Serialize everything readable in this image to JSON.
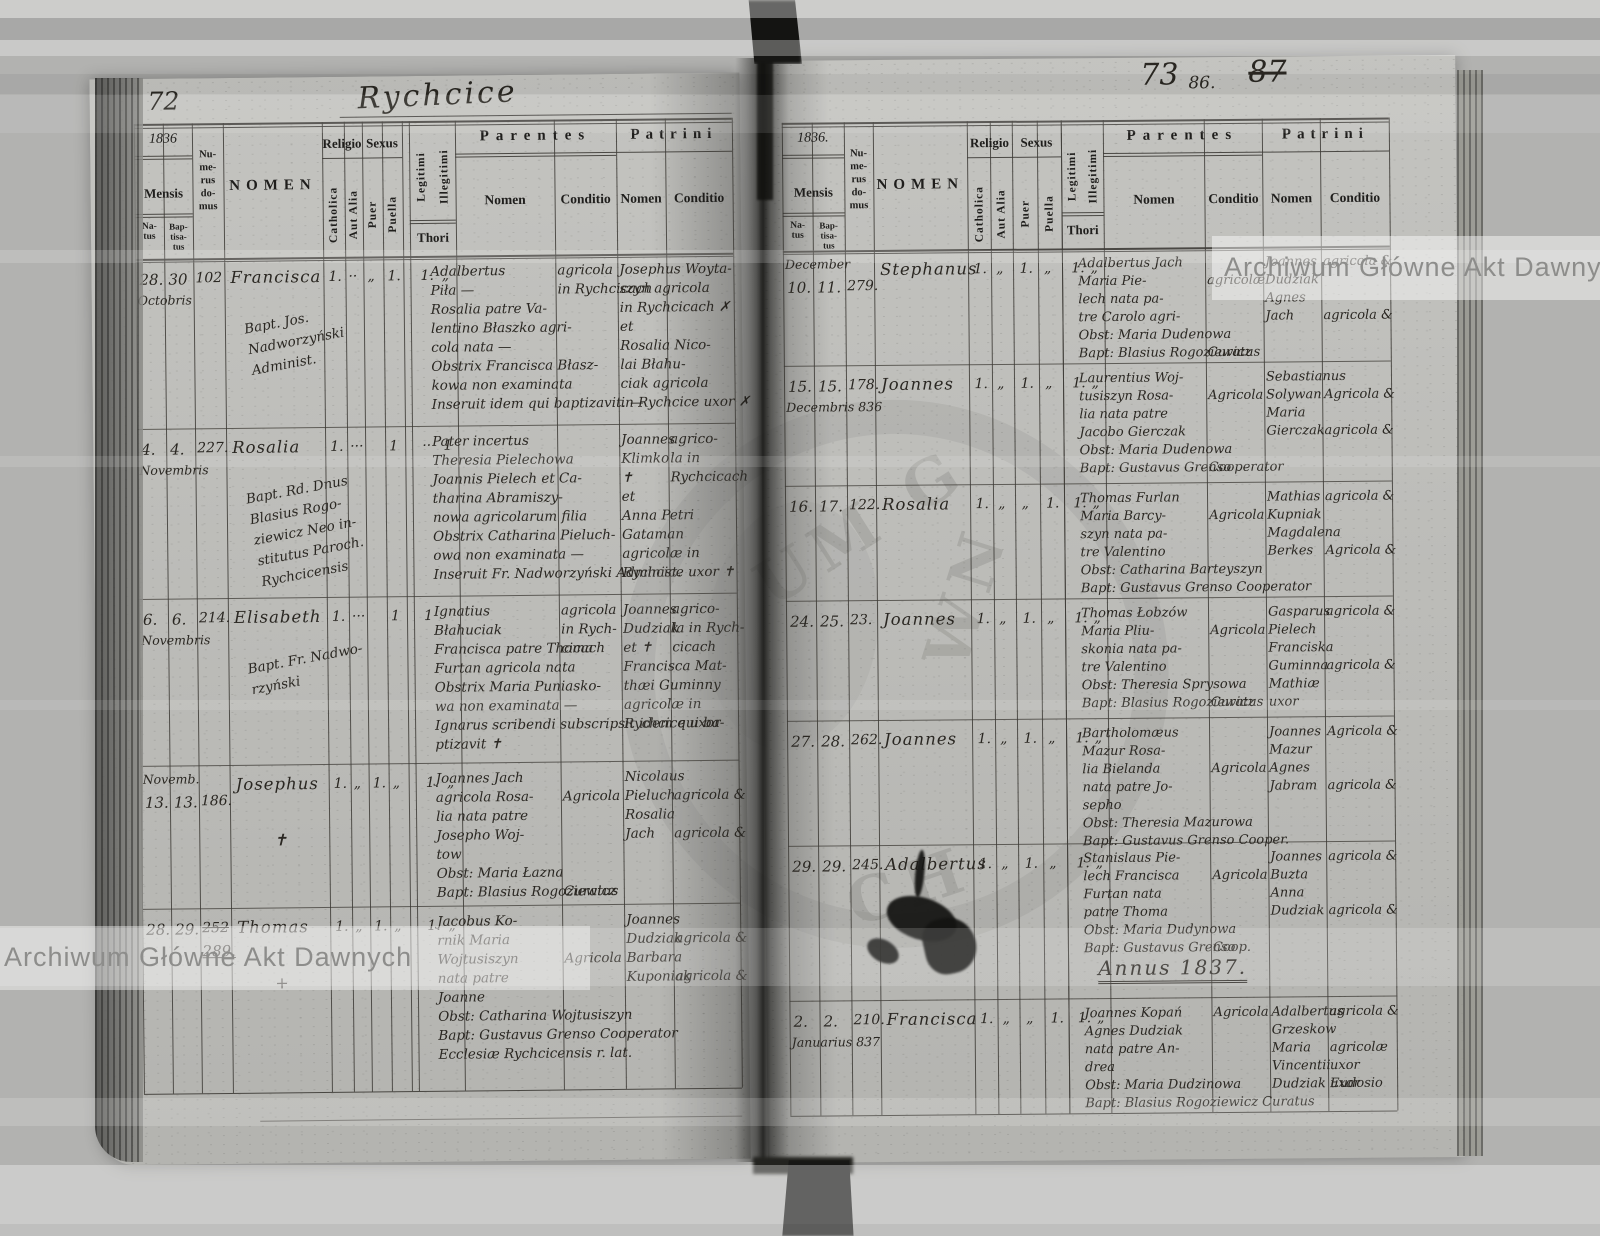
{
  "scan": {
    "watermark_text": "Archiwum Główne Akt Dawnych",
    "stamp_fragments": [
      "UM G",
      "WN",
      "CH"
    ]
  },
  "header_labels": {
    "mensis": "Mensis",
    "natus": "Na-\ntus",
    "baptisatus": "Bap-\ntisa-\ntus",
    "numerus_domus": "Nu-\nme-\nrus\ndo-\nmus",
    "nomen": "NOMEN",
    "religio": "Religio",
    "catholica": "Catholica",
    "aut_alia": "Aut Alia",
    "sexus": "Sexus",
    "puer": "Puer",
    "puella": "Puella",
    "legitimi": "Legitimi",
    "illegitimi": "Illegitimi",
    "thori": "Thori",
    "parentes": "Parentes",
    "patrini": "Patrini",
    "nomen_sub": "Nomen",
    "conditio": "Conditio"
  },
  "page_left": {
    "page_number": "72",
    "title_script": "Rychcice",
    "year": "1836",
    "entries": [
      {
        "natus": "28.",
        "baptisatus": "30",
        "month": "Octobris",
        "month_pos": "below",
        "house": "102",
        "house_struck": false,
        "house2": "",
        "name": "Francisca",
        "name_mark": "",
        "clergy_note": [
          "Bapt. Jos.",
          "Nadworzyński",
          "Administ."
        ],
        "marks": {
          "catholica": "1.",
          "aut_alia": "··",
          "puer": "„",
          "puella": "1.",
          "legitimi": "1.",
          "illegitimi": "„"
        },
        "parentes_nomen": [
          "Adalbertus",
          "Piła —",
          "Rosalia patre Va-",
          "lentino Błaszko agri-",
          "cola nata —",
          "Obstrix Francisca Błasz-",
          "kowa non examinata",
          "Inseruit idem qui baptizavit. —"
        ],
        "parentes_conditio": [
          "agricola",
          "in Rychcicach"
        ],
        "patrini_nomen": [
          "Josephus Woyta-",
          "szyn agricola",
          "in Rychcicach ✗",
          "et",
          "Rosalia Nico-",
          "lai Błahu-",
          "ciak agricola",
          "in Rychcice uxor ✗"
        ],
        "patrini_conditio": []
      },
      {
        "natus": "4.",
        "baptisatus": "4.",
        "month": "Novembris",
        "month_pos": "below",
        "house": "227.",
        "house_struck": false,
        "house2": "",
        "name": "Rosalia",
        "name_mark": "",
        "clergy_note": [
          "Bapt. Rd. Dnus",
          "Blasius Rogo-",
          "ziewicz Neo in-",
          "stitutus Paroch.",
          "Rychcicensis"
        ],
        "marks": {
          "catholica": "1.",
          "aut_alia": "···",
          "puer": "",
          "puella": "1",
          "legitimi": "··",
          "illegitimi": "1"
        },
        "parentes_nomen": [
          "Pater incertus",
          "Theresia Pielechowa",
          "Joannis Pielech et Ca-",
          "tharina Abramiszy-",
          "nowa agricolarum filia",
          "Obstrix Catharina Pieluch-",
          "owa non examinata —",
          "Inseruit Fr. Nadworzyński Administ."
        ],
        "parentes_conditio": [],
        "patrini_nomen": [
          "Joannes",
          "Klimko",
          "✝",
          "et",
          "Anna Petri",
          "Gataman",
          "agricolæ in",
          "Rychcice uxor ✝"
        ],
        "patrini_conditio": [
          "agrico-",
          "la in",
          "Rychcicach"
        ]
      },
      {
        "natus": "6.",
        "baptisatus": "6.",
        "month": "Novembris",
        "month_pos": "below",
        "house": "214.",
        "house_struck": false,
        "house2": "",
        "name": "Elisabeth",
        "name_mark": "",
        "clergy_note": [
          "Bapt. Fr. Nadwo-",
          "rzyński"
        ],
        "marks": {
          "catholica": "1.",
          "aut_alia": "···",
          "puer": "",
          "puella": "1",
          "legitimi": "1",
          "illegitimi": ""
        },
        "parentes_nomen": [
          "Ignatius",
          "Błahuciak",
          "Francisca patre Thoma",
          "Furtan agricola nata",
          "Obstrix Maria Puniasko-",
          "wa non examinata —",
          "Ignarus scribendi subscripsit idem qui ba-",
          "ptizavit ✝"
        ],
        "parentes_conditio": [
          "agricola",
          "in Rych-",
          "cicach"
        ],
        "patrini_nomen": [
          "Joannes",
          "Dudziak",
          "et ✝",
          "Francisca Mat-",
          "thæi Guminny",
          "agricolæ in",
          "Rychcice uxor"
        ],
        "patrini_conditio": [
          "agrico-",
          "la in Rych-",
          "cicach"
        ]
      },
      {
        "natus": "13.",
        "baptisatus": "13.",
        "month": "Novemb.",
        "month_pos": "above",
        "house": "186.",
        "house_struck": false,
        "house2": "",
        "name": "Josephus",
        "name_mark": "✝",
        "clergy_note": [],
        "marks": {
          "catholica": "1.",
          "aut_alia": "„",
          "puer": "1.",
          "puella": "„",
          "legitimi": "1.",
          "illegitimi": "„"
        },
        "parentes_nomen": [
          "Joannes Jach",
          "agricola Rosa-",
          "lia nata patre",
          "Josepho Woj-",
          "tow",
          "Obst: Maria Łazna",
          "Bapt: Blasius Rogoziewicz"
        ],
        "parentes_conditio": [
          "",
          "Agricola",
          "",
          "",
          "",
          "",
          "Curatus"
        ],
        "patrini_nomen": [
          "Nicolaus",
          "Pieluch",
          "Rosalia",
          "Jach"
        ],
        "patrini_conditio": [
          "",
          "agricola &",
          "",
          "agricola &"
        ]
      },
      {
        "natus": "28.",
        "baptisatus": "29.",
        "month": "",
        "month_pos": "below",
        "house": "252",
        "house_struck": true,
        "house2": "289.",
        "name": "Thomas",
        "name_mark": "+",
        "clergy_note": [],
        "marks": {
          "catholica": "1.",
          "aut_alia": "„",
          "puer": "1.",
          "puella": "„",
          "legitimi": "1.",
          "illegitimi": "„"
        },
        "parentes_nomen": [
          "Jacobus Ko-",
          "rnik Maria",
          "Wojtusiszyn",
          "nata patre",
          "Joanne",
          "Obst: Catharina Wojtusiszyn",
          "Bapt: Gustavus Grenso Cooperator",
          "Ecclesiæ Rychcicensis r. lat."
        ],
        "parentes_conditio": [
          "",
          "",
          "Agricola"
        ],
        "patrini_nomen": [
          "Joannes",
          "Dudziak",
          "Barbara",
          "Kuponiak"
        ],
        "patrini_conditio": [
          "",
          "agricola &",
          "",
          "agricola &"
        ]
      }
    ]
  },
  "page_right": {
    "page_number_main": "73",
    "page_number_small": "86.",
    "page_number_struck": "87",
    "year": "1836.",
    "annus_heading": "Annus 1837.",
    "entries": [
      {
        "natus": "10.",
        "baptisatus": "11.",
        "month": "December",
        "month_pos": "above",
        "house": "279.",
        "house_struck": false,
        "house2": "",
        "name": "Stephanus",
        "name_mark": "",
        "clergy_note": [],
        "marks": {
          "catholica": "1.",
          "aut_alia": "„",
          "puer": "1.",
          "puella": "„",
          "legitimi": "1.",
          "illegitimi": "„"
        },
        "parentes_nomen": [
          "Adalbertus Jach",
          "Maria Pie-",
          "lech nata pa-",
          "tre Carolo agri-",
          "Obst: Maria Dudenowa",
          "Bapt: Blasius Rogoziewicz"
        ],
        "parentes_conditio": [
          "",
          "agricolæ",
          "",
          "",
          "",
          "Curatus"
        ],
        "patrini_nomen": [
          "Joannes",
          "Dudziak",
          "Agnes",
          "Jach"
        ],
        "patrini_conditio": [
          "agricola &",
          "",
          "",
          "agricola &"
        ]
      },
      {
        "natus": "15.",
        "baptisatus": "15.",
        "month": "Decembris 836",
        "month_pos": "below",
        "house": "178.",
        "house_struck": false,
        "house2": "",
        "name": "Joannes",
        "name_mark": "",
        "clergy_note": [],
        "marks": {
          "catholica": "1.",
          "aut_alia": "„",
          "puer": "1.",
          "puella": "„",
          "legitimi": "1.",
          "illegitimi": "„"
        },
        "parentes_nomen": [
          "Laurentius Woj-",
          "tusiszyn Rosa-",
          "lia nata patre",
          "Jacobo Gierczak",
          "Obst: Maria Dudenowa",
          "Bapt: Gustavus Grenso"
        ],
        "parentes_conditio": [
          "",
          "Agricola",
          "",
          "",
          "",
          "Cooperator"
        ],
        "patrini_nomen": [
          "Sebastianus",
          "Solywan",
          "Maria",
          "Gierczak"
        ],
        "patrini_conditio": [
          "",
          "Agricola &",
          "",
          "agricola &"
        ]
      },
      {
        "natus": "16.",
        "baptisatus": "17.",
        "month": "",
        "month_pos": "below",
        "house": "122.",
        "house_struck": false,
        "house2": "",
        "name": "Rosalia",
        "name_mark": "",
        "clergy_note": [],
        "marks": {
          "catholica": "1.",
          "aut_alia": "„",
          "puer": "„",
          "puella": "1.",
          "legitimi": "1.",
          "illegitimi": "„"
        },
        "parentes_nomen": [
          "Thomas Furlan",
          "Maria Barcy-",
          "szyn nata pa-",
          "tre Valentino",
          "Obst: Catharina Barteyszyn",
          "Bapt: Gustavus Grenso Cooperator"
        ],
        "parentes_conditio": [
          "",
          "Agricola"
        ],
        "patrini_nomen": [
          "Mathias",
          "Kupniak",
          "Magdalena",
          "Berkes"
        ],
        "patrini_conditio": [
          "agricola &",
          "",
          "",
          "Agricola &"
        ]
      },
      {
        "natus": "24.",
        "baptisatus": "25.",
        "month": "",
        "month_pos": "below",
        "house": "23.",
        "house_struck": false,
        "house2": "",
        "name": "Joannes",
        "name_mark": "",
        "clergy_note": [],
        "marks": {
          "catholica": "1.",
          "aut_alia": "„",
          "puer": "1.",
          "puella": "„",
          "legitimi": "1.",
          "illegitimi": "„"
        },
        "parentes_nomen": [
          "Thomas Łobzów",
          "Maria Pliu-",
          "skonia nata pa-",
          "tre Valentino",
          "Obst: Theresia Sprysowa",
          "Bapt: Blasius Rogoziewicz"
        ],
        "parentes_conditio": [
          "",
          "Agricola",
          "",
          "",
          "",
          "Curatus"
        ],
        "patrini_nomen": [
          "Gasparus",
          "Pielech",
          "Franciska",
          "Guminna",
          "Mathiæ",
          "uxor"
        ],
        "patrini_conditio": [
          "agricola &",
          "",
          "",
          "agricola &"
        ]
      },
      {
        "natus": "27.",
        "baptisatus": "28.",
        "month": "",
        "month_pos": "below",
        "house": "262.",
        "house_struck": false,
        "house2": "",
        "name": "Joannes",
        "name_mark": "",
        "clergy_note": [],
        "marks": {
          "catholica": "1.",
          "aut_alia": "„",
          "puer": "1.",
          "puella": "„",
          "legitimi": "1.",
          "illegitimi": "„"
        },
        "parentes_nomen": [
          "Bartholomæus",
          "Mazur Rosa-",
          "lia Bielanda",
          "nata patre Jo-",
          "sepho",
          "Obst: Theresia Mazurowa",
          "Bapt: Gustavus Grenso Cooper."
        ],
        "parentes_conditio": [
          "",
          "",
          "Agricola"
        ],
        "patrini_nomen": [
          "Joannes",
          "Mazur",
          "Agnes",
          "Jabram"
        ],
        "patrini_conditio": [
          "Agricola &",
          "",
          "",
          "agricola &"
        ]
      },
      {
        "natus": "29.",
        "baptisatus": "29.",
        "month": "",
        "month_pos": "below",
        "house": "245.",
        "house_struck": false,
        "house2": "",
        "name": "Adalbertus",
        "name_mark": "",
        "clergy_note": [],
        "marks": {
          "catholica": "1.",
          "aut_alia": "„",
          "puer": "1.",
          "puella": "„",
          "legitimi": "1.",
          "illegitimi": "„"
        },
        "parentes_nomen": [
          "Stanislaus Pie-",
          "lech Francisca",
          "Furtan nata",
          "patre Thoma",
          "Obst: Maria Dudynowa",
          "Bapt: Gustavus Grenso"
        ],
        "parentes_conditio": [
          "",
          "Agricola",
          "",
          "",
          "",
          "Coop."
        ],
        "patrini_nomen": [
          "Joannes",
          "Buzta",
          "Anna",
          "Dudziak"
        ],
        "patrini_conditio": [
          "agricola &",
          "",
          "",
          "agricola &"
        ]
      },
      {
        "natus": "2.",
        "baptisatus": "2.",
        "month": "Januarius 837",
        "month_pos": "below",
        "house": "210.",
        "house_struck": false,
        "house2": "",
        "name": "Francisca",
        "name_mark": "",
        "clergy_note": [],
        "marks": {
          "catholica": "1.",
          "aut_alia": "„",
          "puer": "„",
          "puella": "1.",
          "legitimi": "1.",
          "illegitimi": "„"
        },
        "parentes_nomen": [
          "Joannes Kopań",
          "Agnes Dudziak",
          "nata patre An-",
          "drea",
          "Obst: Maria Dudzinowa",
          "Bapt: Blasius Rogoziewicz Curatus"
        ],
        "parentes_conditio": [
          "Agricola"
        ],
        "patrini_nomen": [
          "Adalbertus",
          "Grzeskow",
          "Maria",
          "Vincentii",
          "Dudziak uxor"
        ],
        "patrini_conditio": [
          "agricola &",
          "",
          "agricolæ",
          "uxor",
          "Eudosio"
        ]
      }
    ]
  }
}
